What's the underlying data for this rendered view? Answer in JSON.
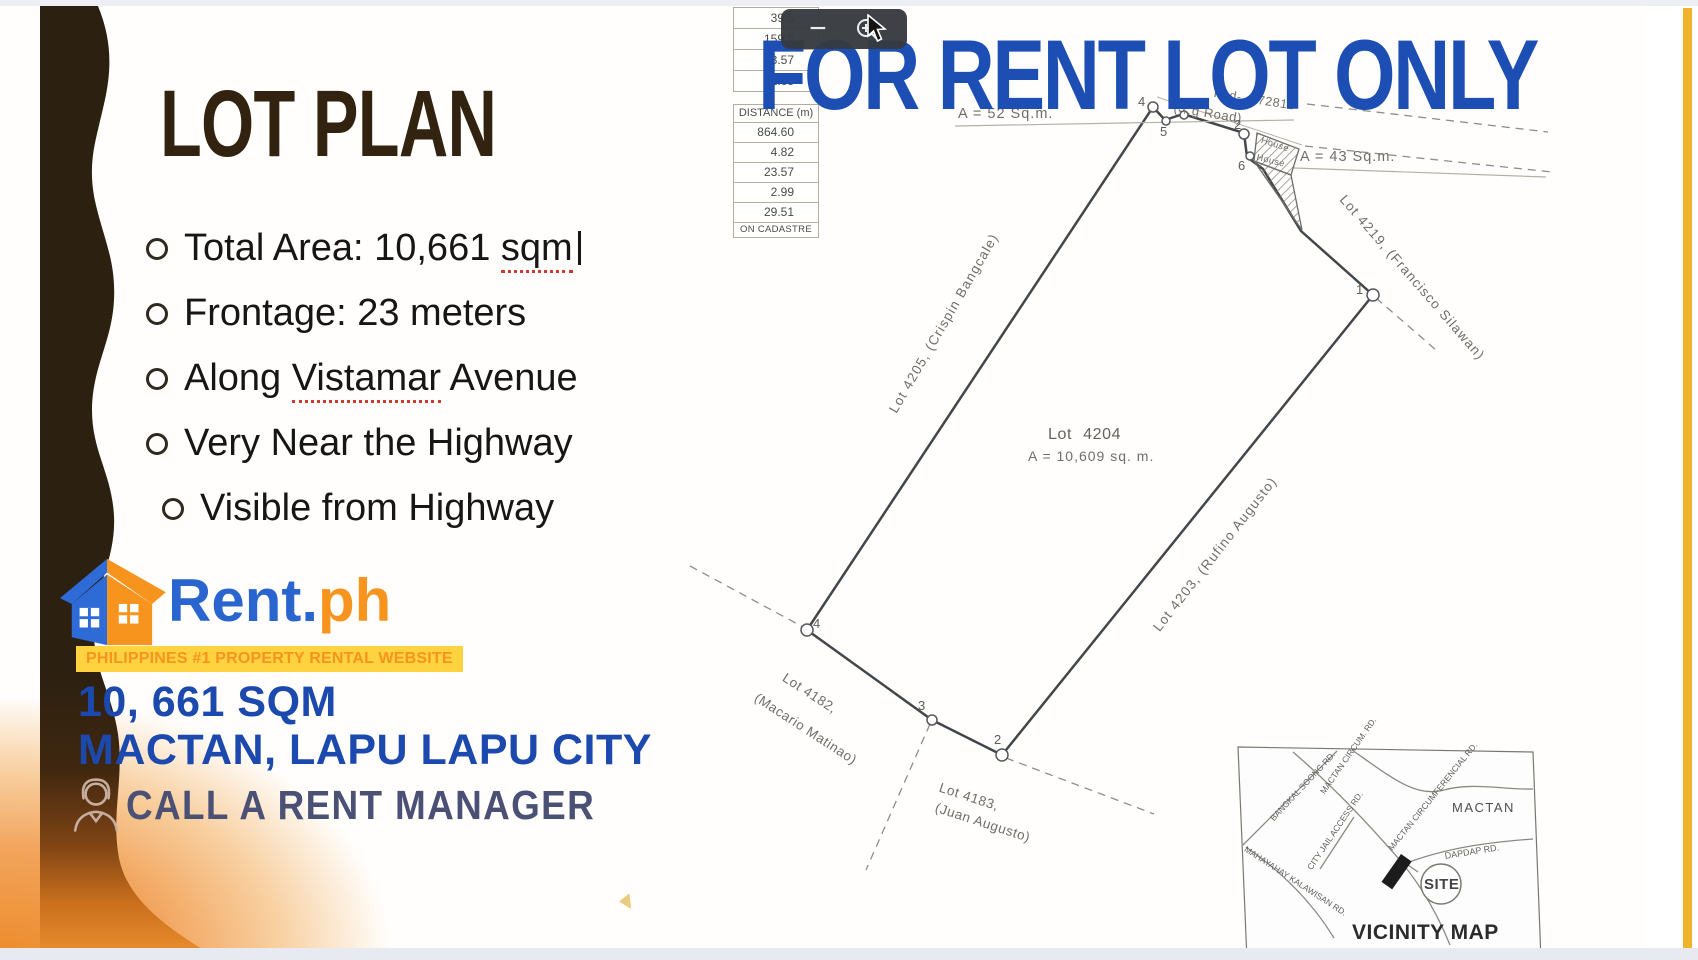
{
  "colors": {
    "headline_blue": "#1c4eb4",
    "brand_orange": "#f7941e",
    "banner_yellow": "#ffd23f",
    "title_brown": "#31230f",
    "cta_slate": "#4a5175",
    "amber_bar": "#f0b32c"
  },
  "headline": {
    "text": "FOR RENT LOT ONLY"
  },
  "viewer": {
    "zoom_out_icon": "−",
    "zoom_in_icon": "+"
  },
  "left_panel": {
    "title": "LOT PLAN",
    "bullets": [
      {
        "pre": "Total Area: 10,661 ",
        "marked": "sqm",
        "post": ""
      },
      {
        "pre": "Frontage: 23 meters"
      },
      {
        "pre": "Along ",
        "marked": "Vistamar",
        "post": " Avenue"
      },
      {
        "pre": "Very Near the Highway"
      },
      {
        "pre": "Visible from Highway"
      }
    ],
    "logo": {
      "word_rent": "Rent",
      "word_dot": ".",
      "word_ph": "ph",
      "tagline": "PHILIPPINES #1 PROPERTY RENTAL WEBSITE"
    },
    "area_line": "10, 661 SQM",
    "location_line": "MACTAN, LAPU LAPU CITY",
    "cta": "CALL A RENT MANAGER"
  },
  "survey_table": {
    "pre_rows": [
      "39.5",
      "159.5",
      "23.57",
      "51.65"
    ],
    "header": "DISTANCE (m)",
    "rows": [
      "864.60",
      "4.82",
      "23.57",
      "2.99",
      "29.51"
    ],
    "footer": "ON CADASTRE"
  },
  "plan": {
    "labels": {
      "a52": "A = 52 Sq.m.",
      "road": "(…g Road)",
      "psd": "Psd- -072811",
      "house1": "House",
      "house2": "House",
      "a43": "A = 43 Sq.m.",
      "lot4219": "Lot 4219, (Francisco Silawan)",
      "lot4205": "Lot 4205, (Crispin Bangcale)",
      "lot4204": "Lot 4204",
      "area4204": "A = 10,609 sq. m.",
      "lot4203": "Lot 4203, (Rufino Augusto)",
      "lot4182": "Lot 4182,",
      "lot4182b": "(Macario Matinao)",
      "lot4183": "Lot 4183,",
      "lot4183b": "(Juan Augusto)"
    },
    "corners": {
      "top4": "4",
      "top5": "5",
      "top3": "3",
      "top2": "2",
      "mid6": "6",
      "right1": "1",
      "bottom2": "2",
      "bottom3": "3",
      "left4": "4"
    }
  },
  "vicinity": {
    "title": "VICINITY MAP",
    "note": "NOT DRAWN TO SCALE",
    "region": "MACTAN",
    "site": "SITE",
    "roads": [
      "BANGKAL SOONG RD.",
      "MACTAN CIRCUM. RD.",
      "MACTAN CIRCUMFERENCIAL RD.",
      "CITY JAIL ACCESS RD.",
      "MAHAYAHAY KALAWISAN RD.",
      "DAPDAP RD."
    ]
  }
}
